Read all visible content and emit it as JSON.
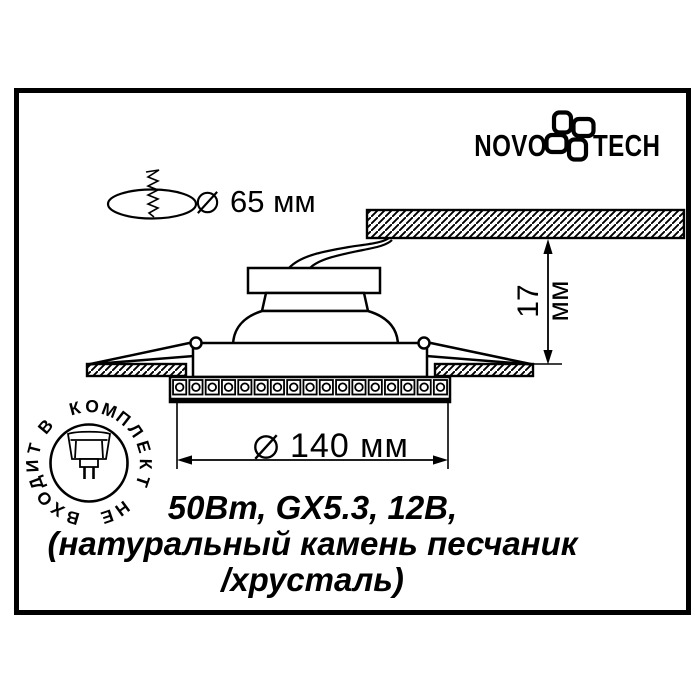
{
  "brand": {
    "name_left": "NOVO",
    "name_right": "TECH"
  },
  "diagram": {
    "cutout_diameter_label": "65 мм",
    "depth_label": "17 мм",
    "overall_diameter_label": "140 мм"
  },
  "stamp": {
    "ring_text": "В КОМПЛЕКТ НЕ ВХОДИТ"
  },
  "specs": {
    "line1": "50Вт, GX5.3, 12В,",
    "line2": "(натуральный камень песчаник",
    "line3": "/хрусталь)"
  },
  "colors": {
    "ink": "#000000",
    "paper": "#ffffff"
  }
}
